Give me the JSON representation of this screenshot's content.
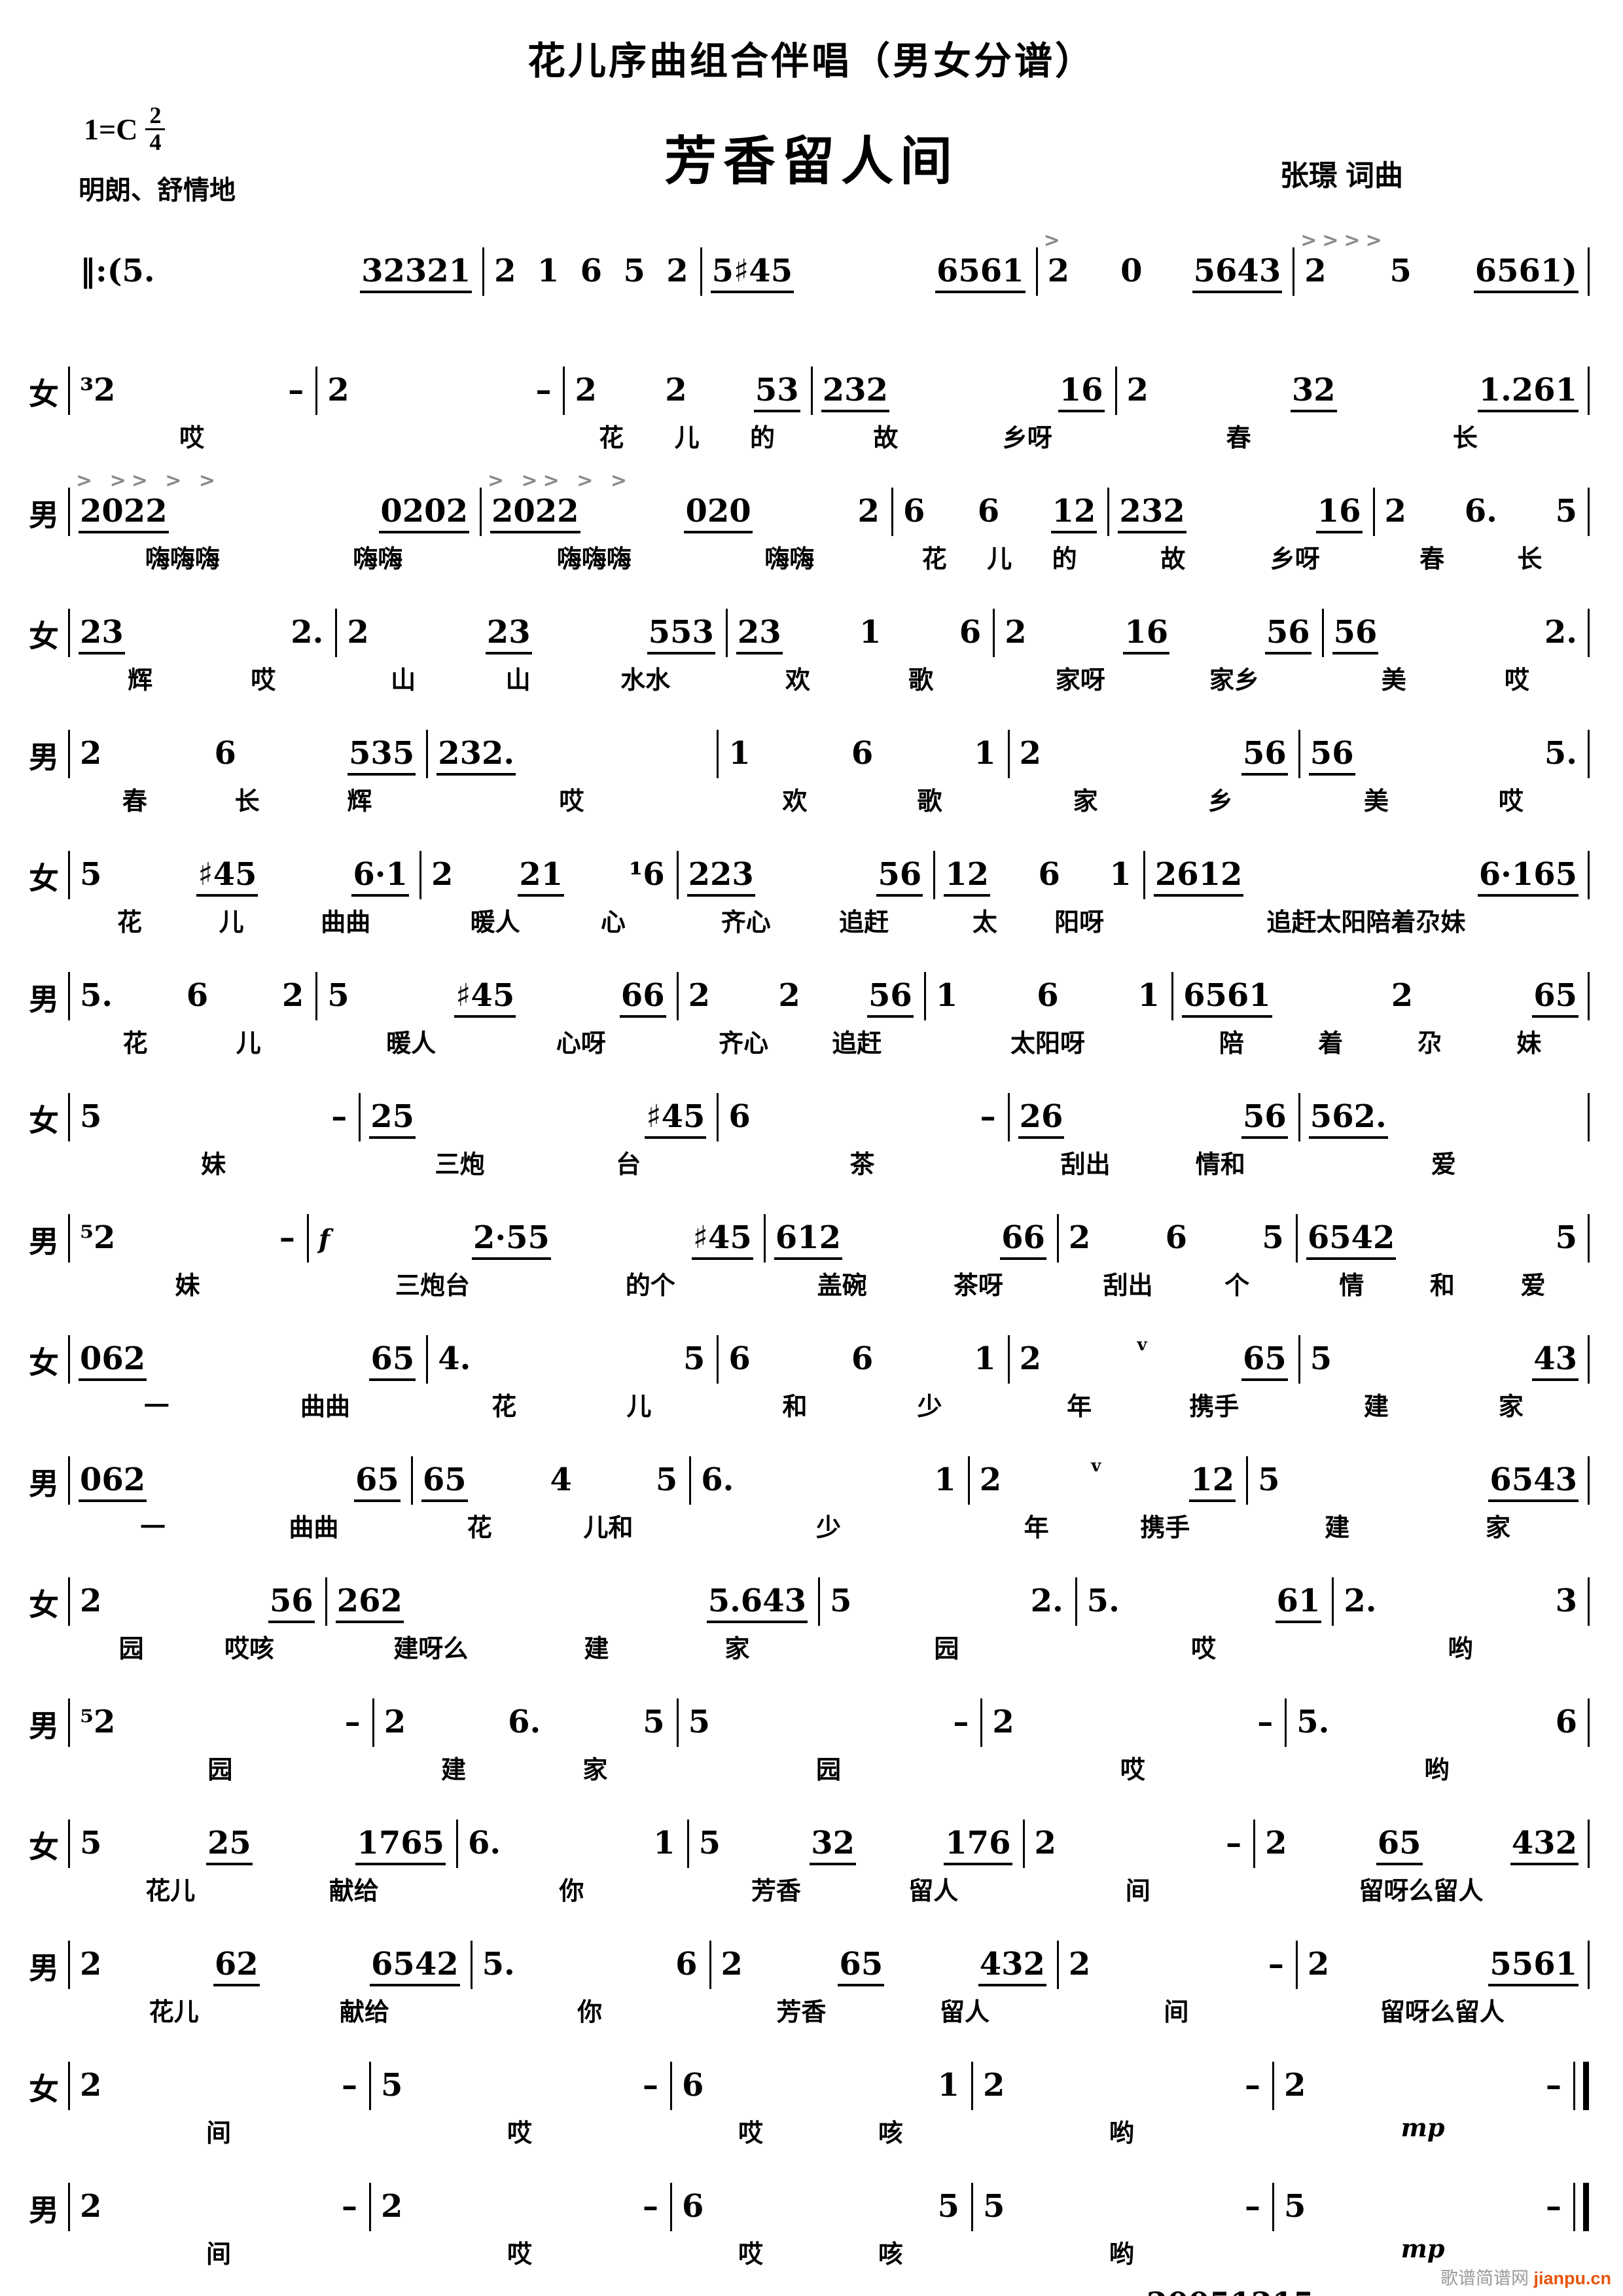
{
  "header": {
    "series_title": "花儿序曲组合伴唱（男女分谱）",
    "song_title": "芳香留人间",
    "key": "1=C",
    "meter_upper": "2",
    "meter_lower": "4",
    "tempo": "明朗、舒情地",
    "composer": "张璟 词曲"
  },
  "score": {
    "lines": [
      {
        "voice": "",
        "no_start_bar": true,
        "accents": [
          "",
          "",
          "",
          ">",
          ">>>>"
        ],
        "measures": [
          "‖:(5. 32321",
          "2 1 6 5 2",
          "5♯45 6561",
          "2 0 5643",
          "2 5 6561)"
        ],
        "lyrics": [
          "",
          "",
          "",
          "",
          ""
        ]
      },
      {
        "voice": "女",
        "gap_before": true,
        "measures": [
          "³2 –",
          "2 –",
          "2 2 53",
          "232 16",
          "2 32 1.261"
        ],
        "lyrics": [
          "哎",
          "",
          "花 儿 的",
          "故 乡呀",
          "春 长"
        ]
      },
      {
        "voice": "男",
        "accents": [
          "> >> > >",
          "> >> > >",
          "",
          "",
          ""
        ],
        "measures": [
          "2022 0202",
          "2022 020 2",
          "6 6 12",
          "232 16",
          "2 6. 5"
        ],
        "lyrics": [
          "嗨嗨嗨 嗨嗨",
          "嗨嗨嗨 嗨嗨",
          "花 儿 的",
          "故 乡呀",
          "春 长"
        ]
      },
      {
        "voice": "女",
        "gap_before": true,
        "measures": [
          "23 2.",
          "2 23 553",
          "23 1 6",
          "2 16 56",
          "56 2."
        ],
        "lyrics": [
          "辉 哎",
          "山 山 水水",
          "欢 歌",
          "家呀 家乡",
          "美 哎"
        ]
      },
      {
        "voice": "男",
        "measures": [
          "2 6 535",
          "232.",
          "1 6 1",
          "2 56",
          "56 5."
        ],
        "lyrics": [
          "春 长 辉",
          "哎",
          "欢 歌",
          "家 乡",
          "美 哎"
        ]
      },
      {
        "voice": "女",
        "gap_before": true,
        "measures": [
          "5 ♯45 6·1",
          "2 21 ¹6",
          "223 56",
          "12 6 1",
          "2612 6·165"
        ],
        "lyrics": [
          "花 儿 曲曲",
          "暖人 心",
          "齐心 追赶",
          "太 阳呀",
          "追赶太阳陪着尕妹"
        ]
      },
      {
        "voice": "男",
        "measures": [
          "5. 6 2",
          "5 ♯45 66",
          "2 2 56",
          "1 6 1",
          "6561 2 65"
        ],
        "lyrics": [
          "花 儿",
          "暖人 心呀",
          "齐心 追赶",
          "太阳呀",
          "陪 着 尕 妹"
        ]
      },
      {
        "voice": "女",
        "gap_before": true,
        "measures": [
          "5 –",
          "25 ♯45",
          "6 –",
          "26 56",
          "562."
        ],
        "lyrics": [
          "妹",
          "三炮 台",
          "茶",
          "刮出 情和",
          "爱"
        ]
      },
      {
        "voice": "男",
        "measures": [
          "⁵2 –",
          "f 2·55 ♯45",
          "612 66",
          "2 6 5",
          "6542 5"
        ],
        "lyrics": [
          "妹",
          "三炮台 的个",
          "盖碗 茶呀",
          "刮出 个",
          "情 和 爱"
        ]
      },
      {
        "voice": "女",
        "gap_before": true,
        "measures": [
          "062 65",
          "4. 5",
          "6 6 1",
          "2 v 65",
          "5 43"
        ],
        "lyrics": [
          "一 曲曲",
          "花 儿",
          "和 少",
          "年 携手",
          "建 家"
        ]
      },
      {
        "voice": "男",
        "measures": [
          "062 65",
          "65 4 5",
          "6. 1",
          "2 v 12",
          "5 6543"
        ],
        "lyrics": [
          "一 曲曲",
          "花 儿和",
          "少",
          "年 携手",
          "建 家"
        ]
      },
      {
        "voice": "女",
        "gap_before": true,
        "measures": [
          "2 56",
          "262 5.643",
          "5 2.",
          "5. 61",
          "2. 3"
        ],
        "lyrics": [
          "园 哎咳",
          "建呀么 建 家",
          "园",
          "哎",
          "哟"
        ]
      },
      {
        "voice": "男",
        "measures": [
          "⁵2 –",
          "2 6. 5",
          "5 –",
          "2 –",
          "5. 6"
        ],
        "lyrics": [
          "园",
          "建 家",
          "园",
          "哎",
          "哟"
        ]
      },
      {
        "voice": "女",
        "gap_before": true,
        "measures": [
          "5 25 1765",
          "6. 1",
          "5 32 176",
          "2 –",
          "2 65 432"
        ],
        "lyrics": [
          "花儿 献给",
          "你",
          "芳香 留人",
          "间",
          "留呀么留人"
        ]
      },
      {
        "voice": "男",
        "measures": [
          "2 62 6542",
          "5. 6",
          "2 65 432",
          "2 –",
          "2 5561"
        ],
        "lyrics": [
          "花儿 献给",
          "你",
          "芳香 留人",
          "间",
          "留呀么留人"
        ]
      },
      {
        "voice": "女",
        "gap_before": true,
        "end": "final",
        "measures": [
          "2 –",
          "5 –",
          "6 1",
          "2 –",
          "2 –"
        ],
        "lyrics": [
          "间",
          "哎",
          "哎 咳",
          "哟",
          "mp"
        ]
      },
      {
        "voice": "男",
        "end": "final",
        "measures": [
          "2 –",
          "2 –",
          "6 5",
          "5 –",
          "5 –"
        ],
        "lyrics": [
          "间",
          "哎",
          "哎 咳",
          "哟",
          "mp"
        ]
      }
    ]
  },
  "footer": {
    "date": "20051215",
    "watermark_site": "歌谱简谱网",
    "watermark_domain": "jianpu.cn"
  },
  "colors": {
    "accent_marks": "#8a8a8a",
    "watermark_domain": "#e8540c"
  }
}
